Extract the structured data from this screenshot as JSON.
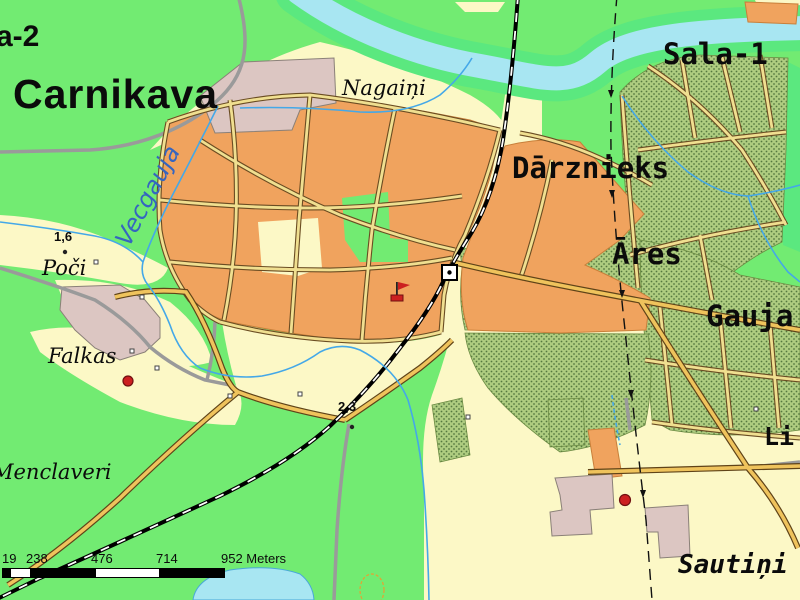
{
  "map": {
    "title": "Topographic map of Carnikava area",
    "labels": {
      "sala2": "a-2",
      "carnikava": "Carnikava",
      "sala1": "Sala-1",
      "nagaini": "Nagaiņi",
      "darznieks": "Dārznieks",
      "ares": "Āres",
      "gauja": "Gauja",
      "li": "Li",
      "vecgauja": "Vecgauja",
      "poci": "Poči",
      "falkas": "Falkas",
      "menclaveri": "Menclaveri",
      "sautini": "Sautiņi",
      "elev_poci": "1,6",
      "elev_crossing": "2,3"
    },
    "scalebar": {
      "t1": "19",
      "t2": "238",
      "t3": "476",
      "t4": "714",
      "t5": "952 Meters"
    },
    "colors": {
      "forest_green": "#72EB72",
      "open_field": "#FCF8C6",
      "water": "#A8E6F2",
      "river_bank_green": "#5BE87F",
      "residential_orange": "#F0A35E",
      "allotment_olive": "#AECC80",
      "builtup_pink": "#DCC6C2",
      "road_major": "#EFC35C",
      "road_minor": "#F0DF90",
      "road_gray": "#9A9A9A",
      "railway": "#000000",
      "stream_blue": "#44A8E8",
      "poi_red": "#CC2020",
      "water_label_blue": "#3565C0"
    },
    "symbols": [
      "railway-station-icon",
      "flag-icon",
      "poi-dot",
      "elevation-dot",
      "building-square",
      "power-line-arrows"
    ]
  }
}
